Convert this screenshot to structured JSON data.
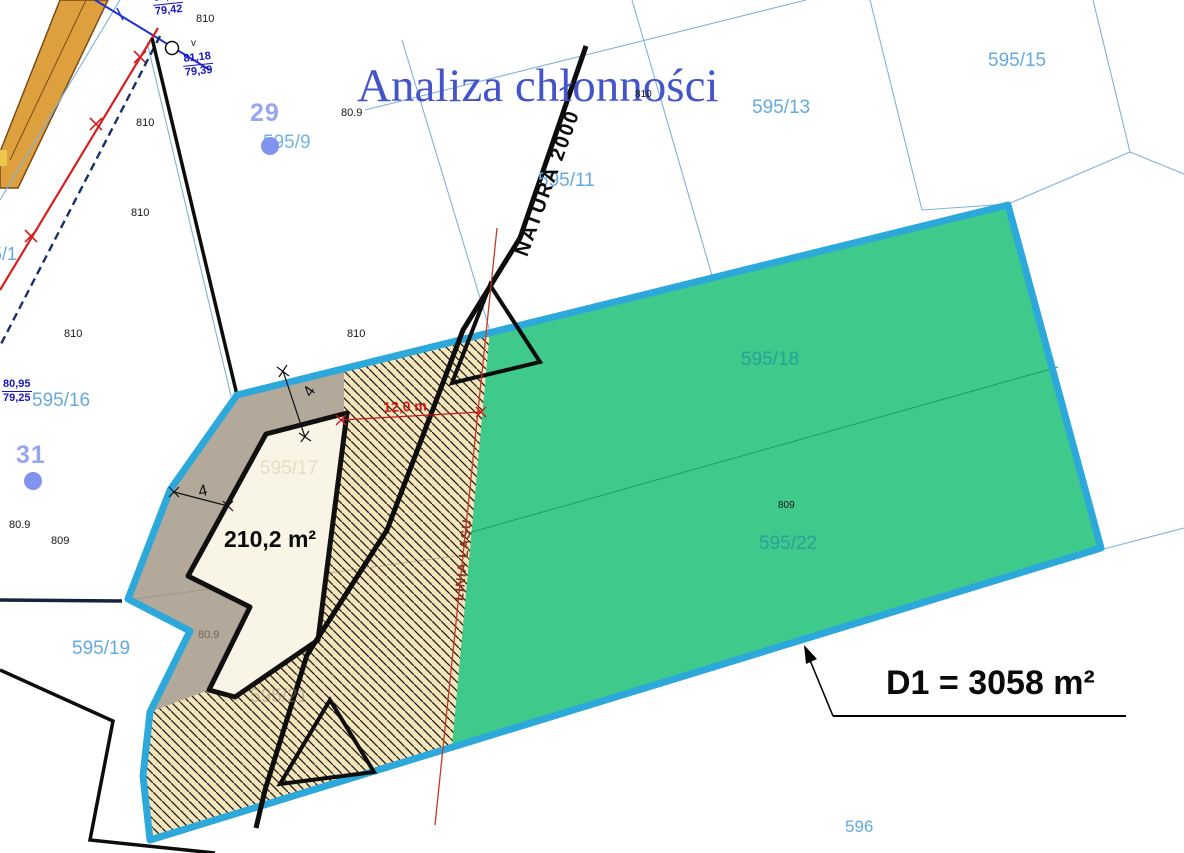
{
  "canvas": {
    "width": 1184,
    "height": 853,
    "background": "#ffffff"
  },
  "colors": {
    "site_boundary": "#2ca8da",
    "green_area": "#3fc98b",
    "green_divider": "#1f9b66",
    "hatch_background": "#f5e5bb",
    "hatch_stroke": "#1c1c1c",
    "gray_area": "#b3a99b",
    "building_fill": "#f8f4e6",
    "building_stroke": "#101010",
    "road_fill": "#de9f3e",
    "road_border": "#7c4a14",
    "parcel_line": "#7fb2de",
    "parcel_label": "#64aade",
    "parcel_label_on_green": "#2aa098",
    "navy_survey_text": "#1717c0",
    "red_dimension": "#cc1818",
    "forest_line_red": "#c23a2a",
    "title_blue": "#4355c8",
    "point_number_blue": "#98a6ef",
    "point_dot_blue": "#8093ef"
  },
  "map": {
    "title": "Analiza chłonności",
    "labels": [
      {
        "name": "page-title",
        "text": "Analiza chłonności",
        "x": 357,
        "y": 63,
        "size": 47,
        "color": "#4355c8",
        "family": "serif"
      },
      {
        "name": "parcel-label-595-15",
        "text": "595/15",
        "x": 988,
        "y": 51,
        "size": 19,
        "color": "#64aade"
      },
      {
        "name": "parcel-label-595-13",
        "text": "595/13",
        "x": 752,
        "y": 98,
        "size": 19,
        "color": "#64aade"
      },
      {
        "name": "parcel-label-595-11",
        "text": "595/11",
        "x": 538,
        "y": 171,
        "size": 19,
        "color": "#64aade"
      },
      {
        "name": "parcel-label-595-9",
        "text": "595/9",
        "x": 263,
        "y": 133,
        "size": 19,
        "color": "#74b4e4"
      },
      {
        "name": "parcel-label-595-16",
        "text": "595/16",
        "x": 32,
        "y": 391,
        "size": 19,
        "color": "#64aade"
      },
      {
        "name": "parcel-label-595-19",
        "text": "595/19",
        "x": 72,
        "y": 639,
        "size": 19,
        "color": "#64aade"
      },
      {
        "name": "parcel-label-596",
        "text": "596",
        "x": 845,
        "y": 818,
        "size": 17,
        "color": "#64aade"
      },
      {
        "name": "parcel-label-left-partial",
        "text": "5/1",
        "x": -8,
        "y": 245,
        "size": 18,
        "color": "#64aade"
      },
      {
        "name": "parcel-label-595-18",
        "text": "595/18",
        "x": 741,
        "y": 350,
        "size": 19,
        "color": "#2aa098"
      },
      {
        "name": "parcel-label-595-22",
        "text": "595/22",
        "x": 759,
        "y": 534,
        "size": 19,
        "color": "#2aa098"
      },
      {
        "name": "parcel-label-595-17",
        "text": "595/17",
        "x": 260,
        "y": 459,
        "size": 19,
        "color": "rgba(228,219,196,0.95)"
      },
      {
        "name": "parcel-label-595-21",
        "text": "595/21",
        "x": 250,
        "y": 687,
        "size": 19,
        "color": "rgba(140,132,105,0.5)"
      },
      {
        "name": "point-number-29",
        "text": "29",
        "x": 250,
        "y": 101,
        "size": 25,
        "color": "#98a6ef",
        "weight": 700,
        "ls": 1
      },
      {
        "name": "point-number-31",
        "text": "31",
        "x": 16,
        "y": 443,
        "size": 25,
        "color": "#98a6ef",
        "weight": 700,
        "ls": 1
      },
      {
        "name": "natura-2000-label",
        "text": "NATURA 2000",
        "x": 512,
        "y": 252,
        "size": 20,
        "color": "#0c0c0c",
        "weight": 700,
        "rot": -70,
        "ls": 2
      },
      {
        "name": "linia-lasu-label",
        "text": "LINIA LASU",
        "x": 452,
        "y": 600,
        "size": 13,
        "color": "#8e3424",
        "weight": 700,
        "rot": -84,
        "ls": 1
      },
      {
        "name": "area-d1-label",
        "text": "D1 = 3058 m²",
        "x": 886,
        "y": 666,
        "size": 34,
        "color": "#0a0a0a",
        "weight": 700
      },
      {
        "name": "area-210-label",
        "text": "210,2 m²",
        "x": 224,
        "y": 528,
        "size": 23,
        "color": "#0a0a0a",
        "weight": 700
      },
      {
        "name": "dimension-12m-label",
        "text": "12,0 m",
        "x": 383,
        "y": 400,
        "size": 14,
        "color": "#cc1818",
        "weight": 700,
        "rot": -2
      },
      {
        "name": "dimension-4-top-label",
        "text": "4",
        "x": 301,
        "y": 391,
        "size": 16,
        "color": "#111111",
        "rot": -55
      },
      {
        "name": "dimension-4-left-label",
        "text": "4",
        "x": 197,
        "y": 485,
        "size": 16,
        "color": "#111111",
        "rot": -12
      },
      {
        "name": "elevation-810-a",
        "text": "810",
        "x": 196,
        "y": 14,
        "size": 11,
        "color": "#161616"
      },
      {
        "name": "elevation-810-b",
        "text": "810",
        "x": 136,
        "y": 118,
        "size": 11,
        "color": "#161616"
      },
      {
        "name": "elevation-810-c",
        "text": "810",
        "x": 131,
        "y": 208,
        "size": 11,
        "color": "#161616"
      },
      {
        "name": "elevation-810-d",
        "text": "810",
        "x": 64,
        "y": 329,
        "size": 11,
        "color": "#161616"
      },
      {
        "name": "elevation-810-e",
        "text": "810",
        "x": 347,
        "y": 329,
        "size": 11,
        "color": "#161616"
      },
      {
        "name": "elevation-810-f",
        "text": "810",
        "x": 635,
        "y": 90,
        "size": 10,
        "color": "#161616"
      },
      {
        "name": "elevation-809-a",
        "text": "80.9",
        "x": 341,
        "y": 108,
        "size": 11,
        "color": "#161616"
      },
      {
        "name": "elevation-809-b",
        "text": "80.9",
        "x": 9,
        "y": 520,
        "size": 11,
        "color": "#161616"
      },
      {
        "name": "elevation-809-c",
        "text": "809",
        "x": 51,
        "y": 536,
        "size": 11,
        "color": "#161616"
      },
      {
        "name": "elevation-809-d",
        "text": "80.9",
        "x": 198,
        "y": 630,
        "size": 11,
        "color": "#6f6758"
      },
      {
        "name": "elevation-809-e",
        "text": "809",
        "x": 778,
        "y": 501,
        "size": 10,
        "color": "#161616"
      },
      {
        "name": "survey-point-marker",
        "text": "v",
        "x": 191,
        "y": 39,
        "size": 10,
        "color": "#161616"
      }
    ],
    "elevation_fractions": [
      {
        "name": "elevation-fraction-1",
        "top": "81,38",
        "bottom": "79,42",
        "x": 152,
        "y": -7,
        "rot": -6
      },
      {
        "name": "elevation-fraction-2",
        "top": "81,18",
        "bottom": "79,39",
        "x": 182,
        "y": 54,
        "rot": -6
      },
      {
        "name": "elevation-fraction-3",
        "top": "80,95",
        "bottom": "79,25",
        "x": 2,
        "y": 379,
        "rot": 0
      }
    ],
    "point_dots": [
      {
        "name": "point-dot-29",
        "x": 261,
        "y": 137,
        "d": 18,
        "color": "#8093ef"
      },
      {
        "name": "point-dot-31",
        "x": 24,
        "y": 472,
        "d": 18,
        "color": "#8093ef"
      }
    ]
  }
}
